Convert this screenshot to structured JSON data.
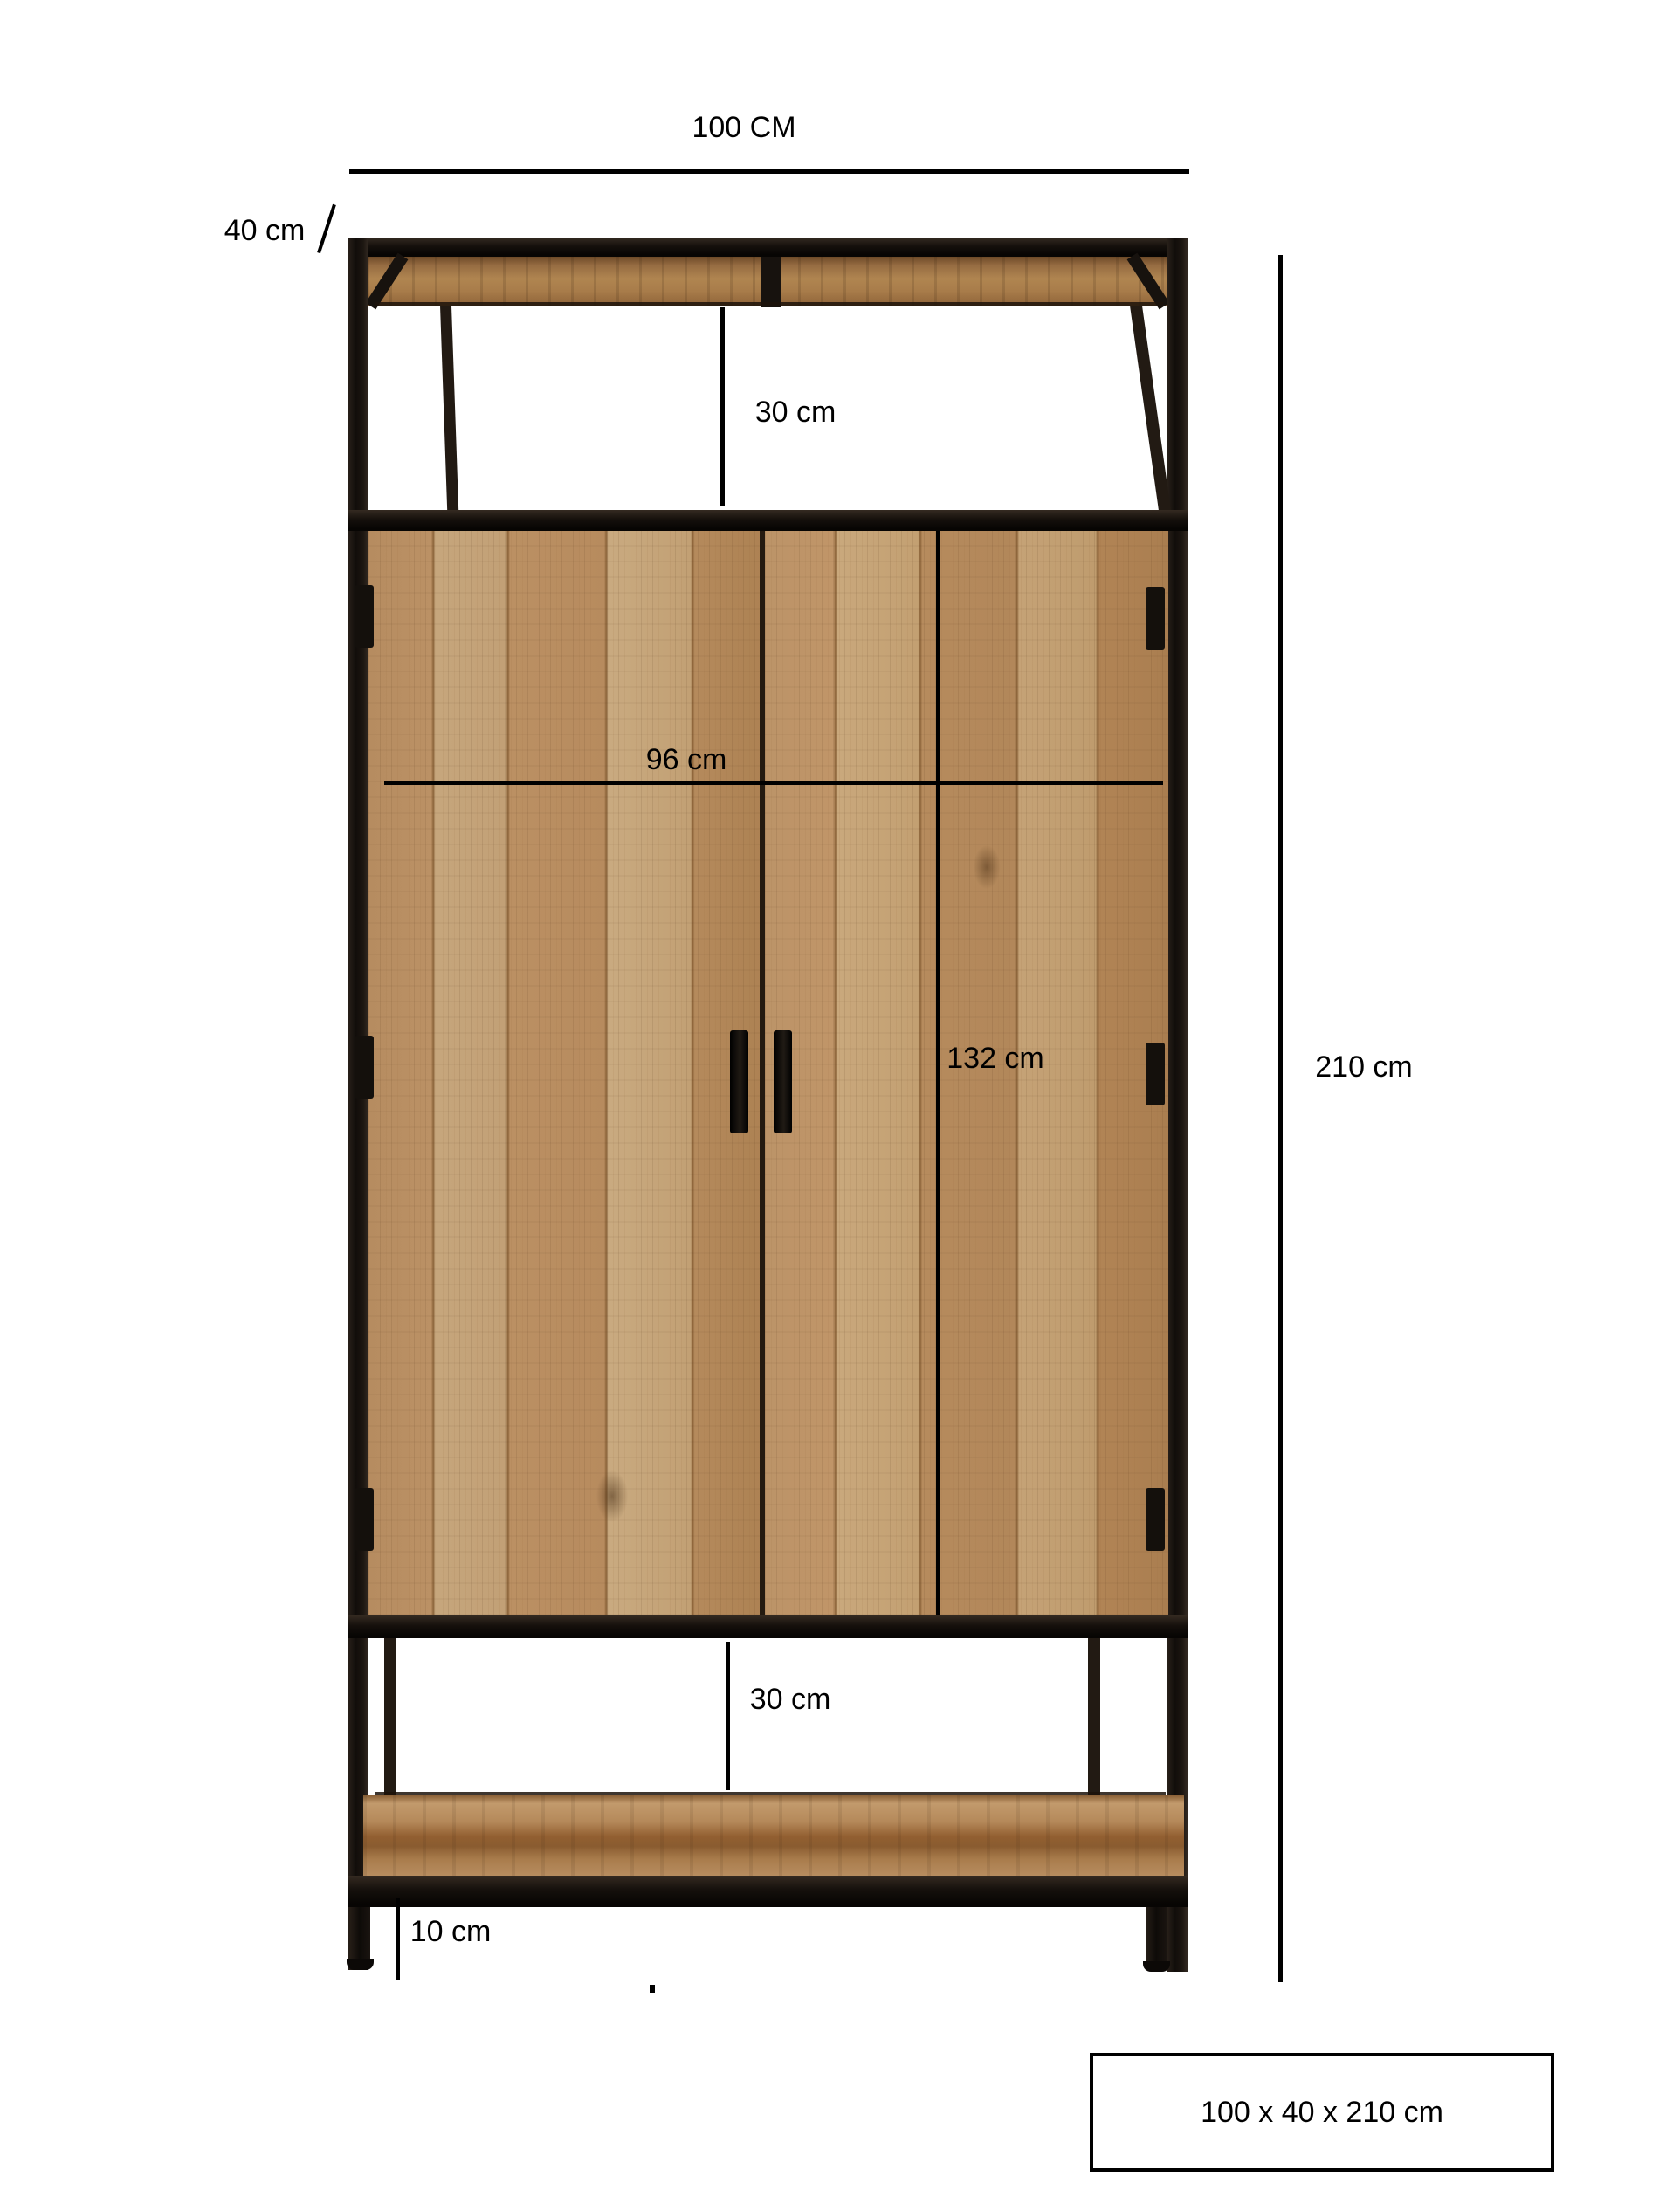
{
  "diagram": {
    "type": "furniture-dimension-diagram",
    "labels": {
      "top_width": "100 CM",
      "depth": "40 cm",
      "top_gap": "30 cm",
      "inner_width": "96 cm",
      "door_height": "132 cm",
      "total_height": "210 cm",
      "bottom_gap": "30 cm",
      "shelf_clearance": "10 cm"
    },
    "summary_box": {
      "label": "100 x 40 x 210 cm"
    },
    "colors": {
      "background": "#ffffff",
      "dimension_line": "#000000",
      "frame_black": "#17120e",
      "wood_mid": "#bd9568",
      "wood_light": "#c9a87c",
      "wood_dark": "#8a5c30"
    }
  }
}
